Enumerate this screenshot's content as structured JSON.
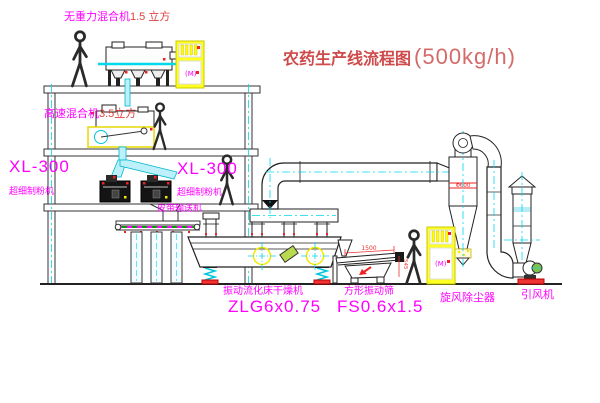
{
  "title": {
    "text": "农药生产线流程图",
    "capacity": "(500kg/h)"
  },
  "equipment": {
    "gravity_mixer": {
      "label": "无重力混合机",
      "spec": "1.5 立方"
    },
    "high_speed_mixer": {
      "label": "高速混合机",
      "spec": "3.5立方"
    },
    "mill_left": {
      "model": "XL-300",
      "label": "超细制粉机"
    },
    "mill_right": {
      "model": "XL-300",
      "label": "超细制粉机"
    },
    "belt_conveyor": {
      "label": "皮带输送机"
    },
    "fluid_bed_dryer": {
      "label": "振动流化床干燥机",
      "model": "ZLG6x0.75"
    },
    "square_sieve": {
      "label": "方形振动筛",
      "model": "FS0.6x1.5"
    },
    "cyclone": {
      "label": "旋风除尘器"
    },
    "induced_fan": {
      "label": "引风机"
    }
  },
  "dimensions": {
    "sieve_length": "1500",
    "sieve_height": "545",
    "cyclone_diameter": "Φ600"
  },
  "control_cabinet": {
    "label": "(M)"
  },
  "colors": {
    "label_magenta": "#ff00ff",
    "annotation_red": "#e04040",
    "centerline_cyan": "#00d8ec",
    "cabinet_yellow": "#ffff00",
    "line_black": "#222222"
  }
}
